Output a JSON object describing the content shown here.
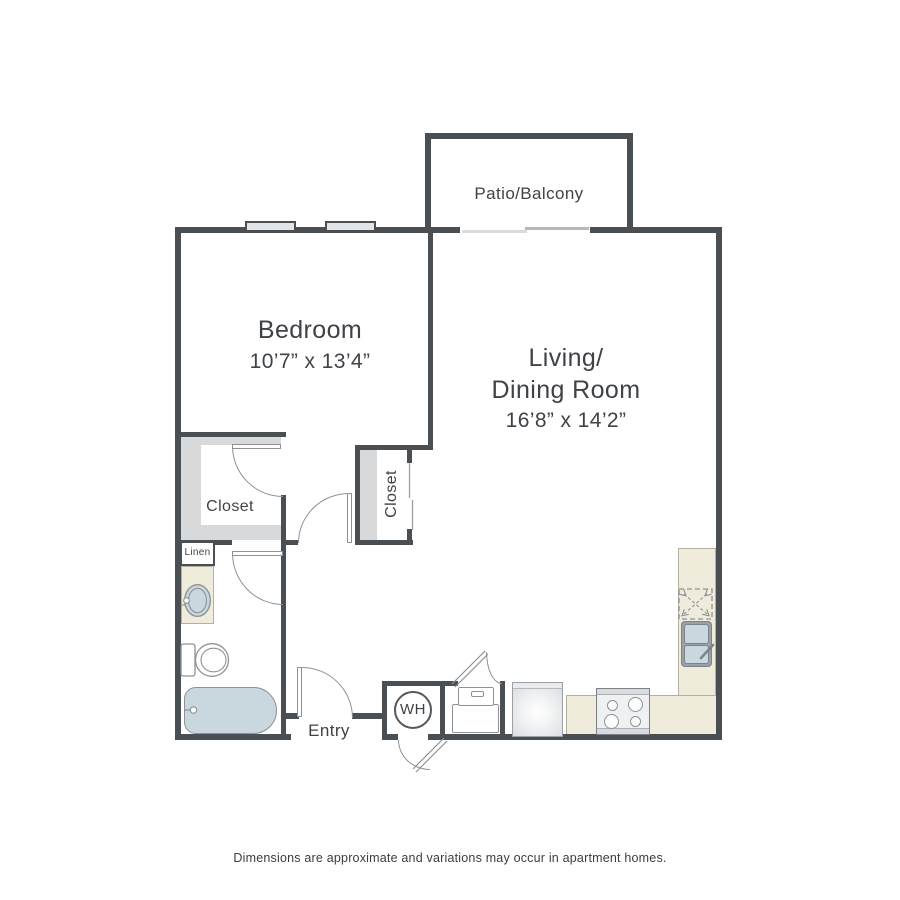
{
  "plan": {
    "labels": {
      "patio": "Patio/Balcony",
      "bedroom_name": "Bedroom",
      "bedroom_dims": "10’7” x 13’4”",
      "living_line1": "Living/",
      "living_line2": "Dining Room",
      "living_dims": "16’8” x 14’2”",
      "closet_left": "Closet",
      "closet_right": "Closet",
      "linen": "Linen",
      "entry": "Entry",
      "water_heater": "WH"
    },
    "colors": {
      "wall": "#4a4f54",
      "fixture_line": "#8e9296",
      "counter": "#efecdb",
      "closet_shade": "#d8d9da",
      "water": "#c9d8de",
      "window_fill": "#e2e5e7",
      "text": "#3f4347"
    }
  },
  "footer": {
    "disclaimer": "Dimensions are approximate and variations may occur in apartment homes."
  }
}
